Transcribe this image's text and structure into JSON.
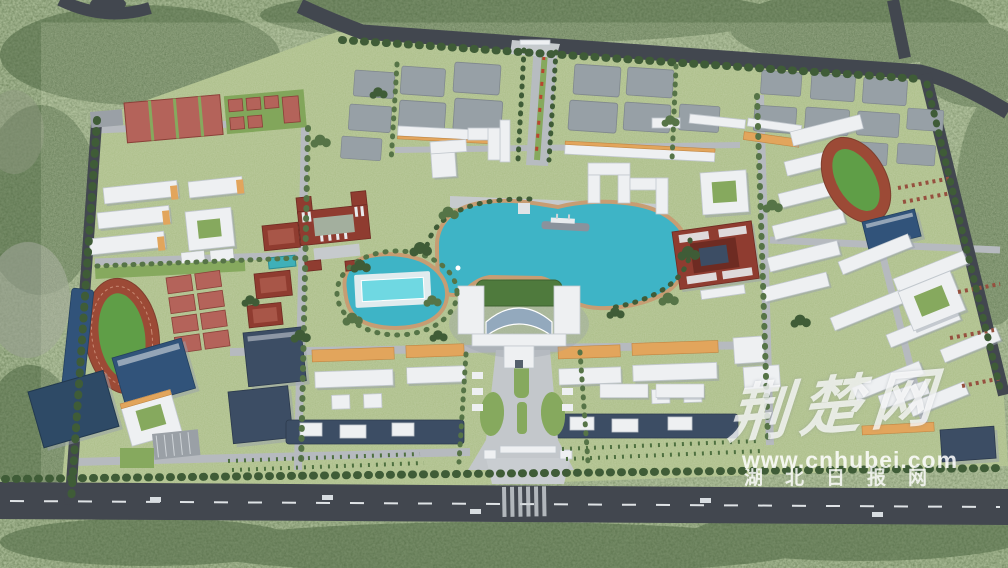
{
  "alt": "Aerial 3D master-plan rendering of a lakeside university campus surrounded by dense forest",
  "watermark": {
    "logo_text": "荆楚网",
    "url": "www.cnhubei.com",
    "site_name": "湖北日报网",
    "text_color": "#ffffff"
  },
  "palette": {
    "forest": "#6a8157",
    "forest_dark": "#4e6743",
    "campus_grass": "#a9bc85",
    "lawn": "#86a95e",
    "lake": "#3eb4c6",
    "pool": "#6fd8e2",
    "road_major": "#42474f",
    "road_minor": "#b6babf",
    "path_tan": "#c79d73",
    "track_red": "#9c4a36",
    "sports_field_green": "#5f9e47",
    "court_red": "#b4635a",
    "roof_dark_blue": "#31537a",
    "glass_dark": "#3c4d64",
    "building_white": "#eef0f2",
    "roof_orange": "#e2a55c",
    "brick_red": "#8f3c30",
    "pad_gray": "#97a0a6",
    "tree_dark": "#3f5c37"
  },
  "features": [
    "central turquoise lake with boat",
    "main administration building with curved glass atrium",
    "south entrance gate and boulevard",
    "north gate axis with tree-lined boulevard",
    "future-phase gray building pads (north)",
    "running track and grandstand (west)",
    "running track and gymnasium (east)",
    "tennis and basketball courts",
    "red-brick courtyard heritage buildings",
    "dormitory slab clusters",
    "teaching clusters with orange roofs and dark glass halls",
    "garden pond with outdoor swimming pool",
    "perimeter roads and surrounding forest"
  ]
}
